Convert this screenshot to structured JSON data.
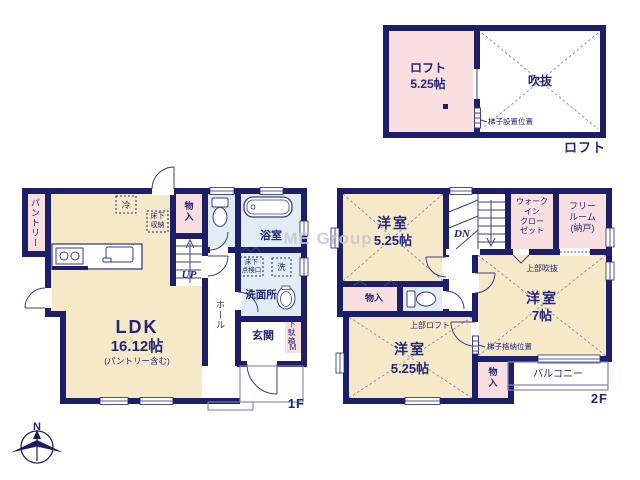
{
  "watermark": "ME Group",
  "compass": {
    "north": "N"
  },
  "loft_plan": {
    "floor_label": "ロフト",
    "loft_room_name": "ロフト",
    "loft_room_area": "5.25帖",
    "void_label": "吹抜",
    "ladder_label": "梯子設置位置"
  },
  "floor1": {
    "floor_label": "1F",
    "ldk_name": "LDK",
    "ldk_area": "16.12帖",
    "ldk_note": "(パントリー含む)",
    "pantry_label": "パントリー",
    "fridge_label": "冷",
    "underfloor_storage_label": "床下\n収納",
    "storage_label": "物\n入",
    "bath_label": "浴室",
    "washroom_label": "洗面所",
    "underfloor_hatch_label": "床下\n点検口",
    "washer_label": "洗",
    "hall_label": "ホール",
    "entrance_label": "玄関",
    "shoe_cabinet_label": "下駄箱",
    "shoe_cabinet_size": "M",
    "stairs_label": "UP"
  },
  "floor2": {
    "floor_label": "2F",
    "bedroom_nw_name": "洋室",
    "bedroom_nw_area": "5.25帖",
    "bedroom_e_name": "洋室",
    "bedroom_e_area": "7帖",
    "bedroom_s_name": "洋室",
    "bedroom_s_area": "5.25帖",
    "wic_label": "ウォーク\nイン\nクロー\nゼット",
    "free_room_label": "フリー\nルーム\n(納戸)",
    "upper_void_label": "上部吹抜",
    "upper_loft_label": "上部ロフト",
    "ladder_label": "梯子格納位置",
    "storage_w_label": "物入",
    "storage_s_label": "物\n入",
    "balcony_label": "バルコニー",
    "stairs_label": "DN"
  },
  "colors": {
    "wall": "#1c1e6a",
    "room_cream": "#f6e9c8",
    "room_pink": "#fadfe0",
    "room_blue": "#e1ecf4",
    "text_navy": "#23267b",
    "watermark_gray": "#c7c7d2"
  }
}
